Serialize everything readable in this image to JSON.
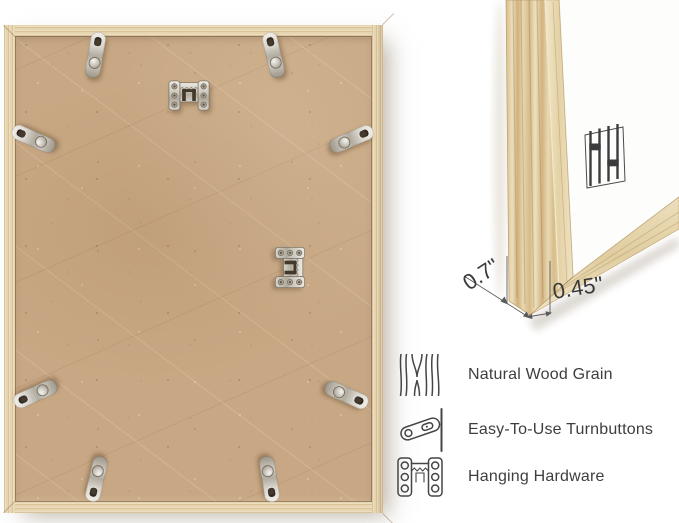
{
  "image": {
    "description_icons": {
      "back_view": "frame-back-photo",
      "hardware": [
        "turnbutton",
        "hanging-hardware"
      ],
      "brand_mark": "double-h-logo"
    },
    "colors": {
      "background": "#ffffff",
      "wood_frame": "#e7d5af",
      "mdf_backing": "#c8a884",
      "metal_hardware": "#cfcac1",
      "text": "#3e3e3e",
      "annotation_line": "#5b5b5b"
    }
  },
  "closeup": {
    "dimensions": {
      "depth_label": "0.7\"",
      "face_label": "0.45\""
    }
  },
  "features": {
    "items": [
      {
        "icon": "wood-grain-icon",
        "label": "Natural Wood Grain"
      },
      {
        "icon": "turnbutton-icon",
        "label": "Easy-To-Use Turnbuttons"
      },
      {
        "icon": "hanging-hardware-icon",
        "label": "Hanging Hardware"
      }
    ]
  }
}
